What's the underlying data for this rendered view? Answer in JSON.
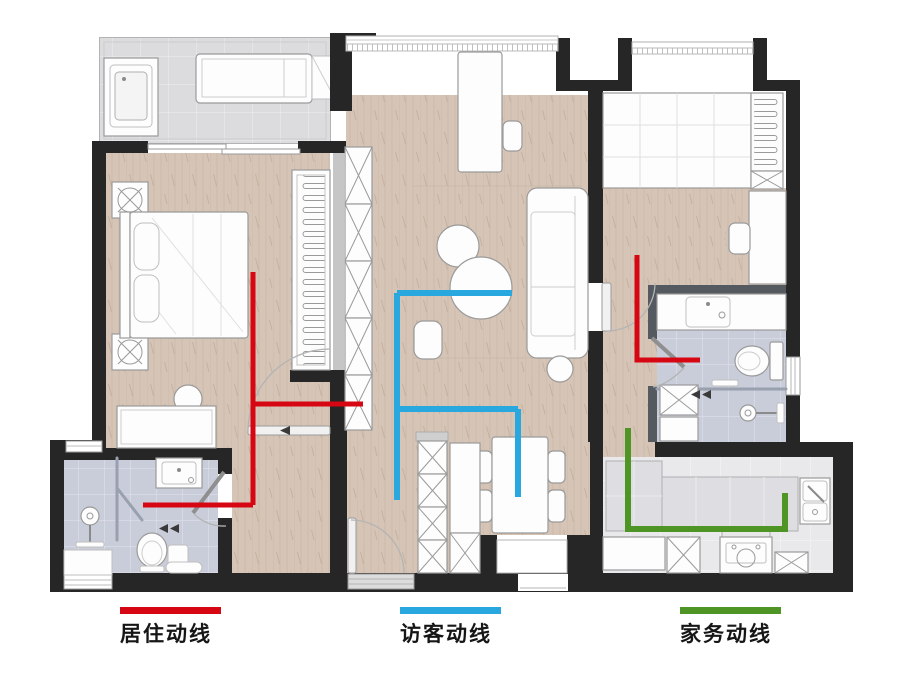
{
  "legend": {
    "items": [
      {
        "id": "living",
        "label": "居住动线",
        "color": "#d60613"
      },
      {
        "id": "visitor",
        "label": "访客动线",
        "color": "#29a8e0"
      },
      {
        "id": "housework",
        "label": "家务动线",
        "color": "#4e9526"
      }
    ]
  },
  "floorplan": {
    "palette": {
      "wall": "#262626",
      "wood_floor": "#d6c5b6",
      "bathroom_floor": "#c9cdda",
      "balcony_floor": "#dcdcde",
      "kitchen_floor": "#e9e9eb"
    },
    "routes": [
      {
        "name": "living-route",
        "color": "#d60613",
        "width": 5,
        "polylines": [
          [
            [
              253,
              272
            ],
            [
              253,
              505
            ]
          ],
          [
            [
              143,
              505
            ],
            [
              253,
              505
            ]
          ],
          [
            [
              253,
              404
            ],
            [
              363,
              404
            ]
          ],
          [
            [
              637,
              255
            ],
            [
              637,
              360
            ],
            [
              700,
              360
            ]
          ]
        ]
      },
      {
        "name": "visitor-route",
        "color": "#29a8e0",
        "width": 6,
        "polylines": [
          [
            [
              397,
              293
            ],
            [
              512,
              293
            ]
          ],
          [
            [
              397,
              293
            ],
            [
              397,
              500
            ]
          ],
          [
            [
              397,
              409
            ],
            [
              518,
              409
            ]
          ],
          [
            [
              518,
              409
            ],
            [
              518,
              497
            ]
          ]
        ]
      },
      {
        "name": "housework-route",
        "color": "#4e9526",
        "width": 6,
        "polylines": [
          [
            [
              628,
              428
            ],
            [
              628,
              529
            ],
            [
              785,
              529
            ],
            [
              785,
              493
            ]
          ]
        ]
      }
    ]
  }
}
